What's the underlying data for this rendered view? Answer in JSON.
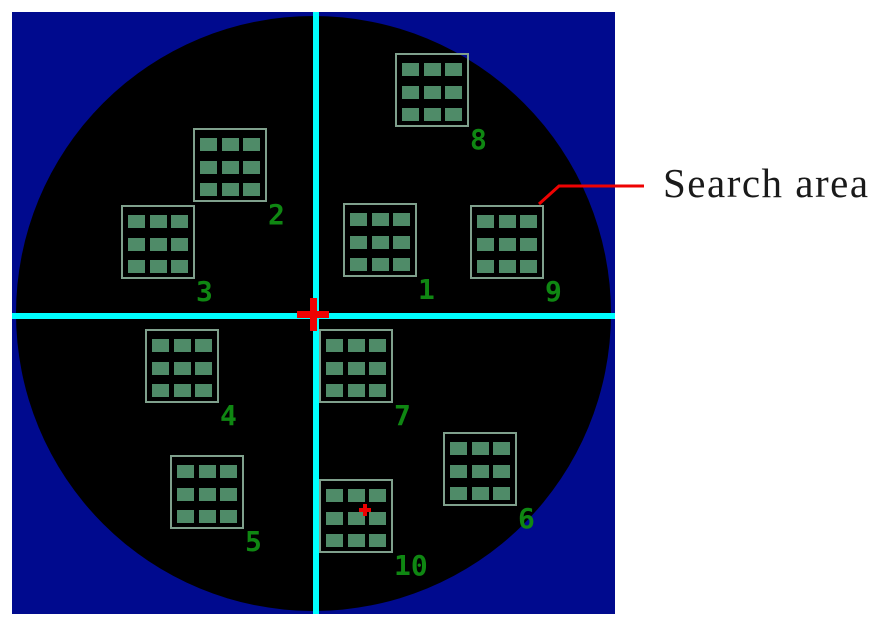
{
  "figure": {
    "annotation": {
      "label": "Search area"
    },
    "wafer": {
      "grid_size": 74,
      "search_areas": [
        {
          "label": "1",
          "x": 343,
          "y": 203
        },
        {
          "label": "2",
          "x": 193,
          "y": 128
        },
        {
          "label": "3",
          "x": 121,
          "y": 205
        },
        {
          "label": "4",
          "x": 145,
          "y": 329
        },
        {
          "label": "5",
          "x": 170,
          "y": 455
        },
        {
          "label": "6",
          "x": 443,
          "y": 432
        },
        {
          "label": "7",
          "x": 319,
          "y": 329
        },
        {
          "label": "8",
          "x": 395,
          "y": 53
        },
        {
          "label": "9",
          "x": 470,
          "y": 205
        },
        {
          "label": "10",
          "x": 319,
          "y": 479
        }
      ],
      "center_cross": {
        "x": 313,
        "y": 314
      },
      "point_marker": {
        "x": 365,
        "y": 510
      },
      "leader_line_points": "539,204 559,186 644,186"
    },
    "colors": {
      "background": "#ffffff",
      "panel_blue": "#000a8e",
      "wafer_black": "#000000",
      "crosshair_cyan": "#00ffff",
      "marker_red": "#ee0202",
      "grid_border_green": "#7fa08c",
      "grid_cell_green": "#4f8b68",
      "number_green": "#0f8712",
      "label_text": "#1a1a1a"
    }
  }
}
